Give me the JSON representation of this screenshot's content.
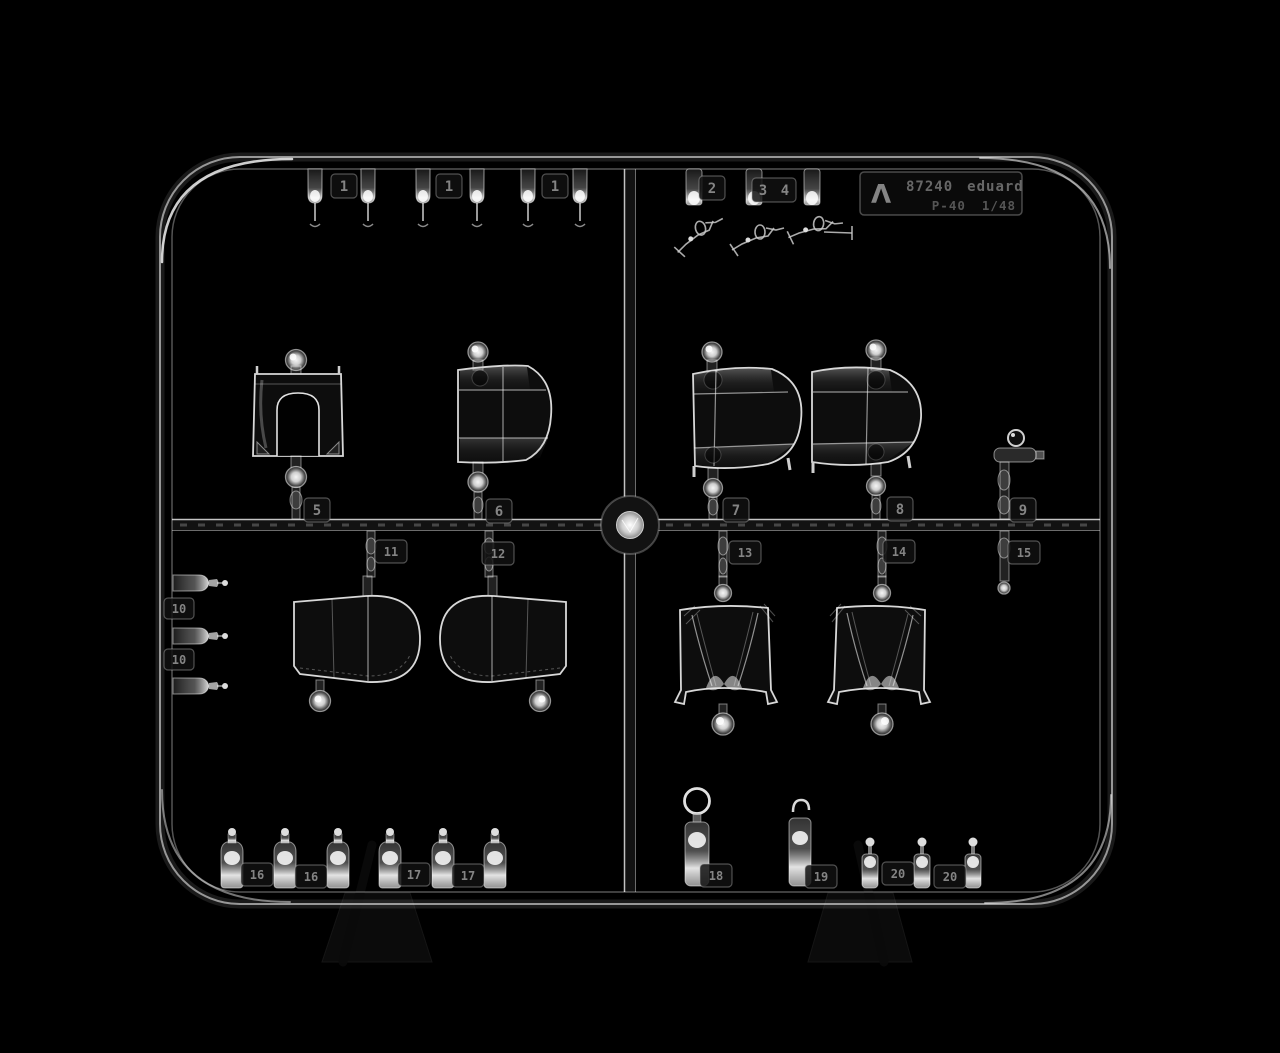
{
  "photo": {
    "subject": "clear-plastic-model-sprue",
    "colors": {
      "background": "#000000",
      "plastic_edge": "#d8d8d8",
      "tag_digits": "#8f8f8f",
      "plate_text": "#6c6c6c"
    }
  },
  "label_plate": {
    "sprue_letter_symbol": "Λ",
    "catalog_code": "87240",
    "brand": "eduard",
    "model": "P-40",
    "scale": "1/48"
  },
  "tags": {
    "n1a": "1",
    "n1b": "1",
    "n1c": "1",
    "n2": "2",
    "n3": "3",
    "n4": "4",
    "n5": "5",
    "n6": "6",
    "n7": "7",
    "n8": "8",
    "n9": "9",
    "n10a": "10",
    "n10b": "10",
    "n11": "11",
    "n12": "12",
    "n13": "13",
    "n14": "14",
    "n15": "15",
    "n16a": "16",
    "n16b": "16",
    "n17a": "17",
    "n17b": "17",
    "n18": "18",
    "n19": "19",
    "n20a": "20",
    "n20b": "20"
  }
}
